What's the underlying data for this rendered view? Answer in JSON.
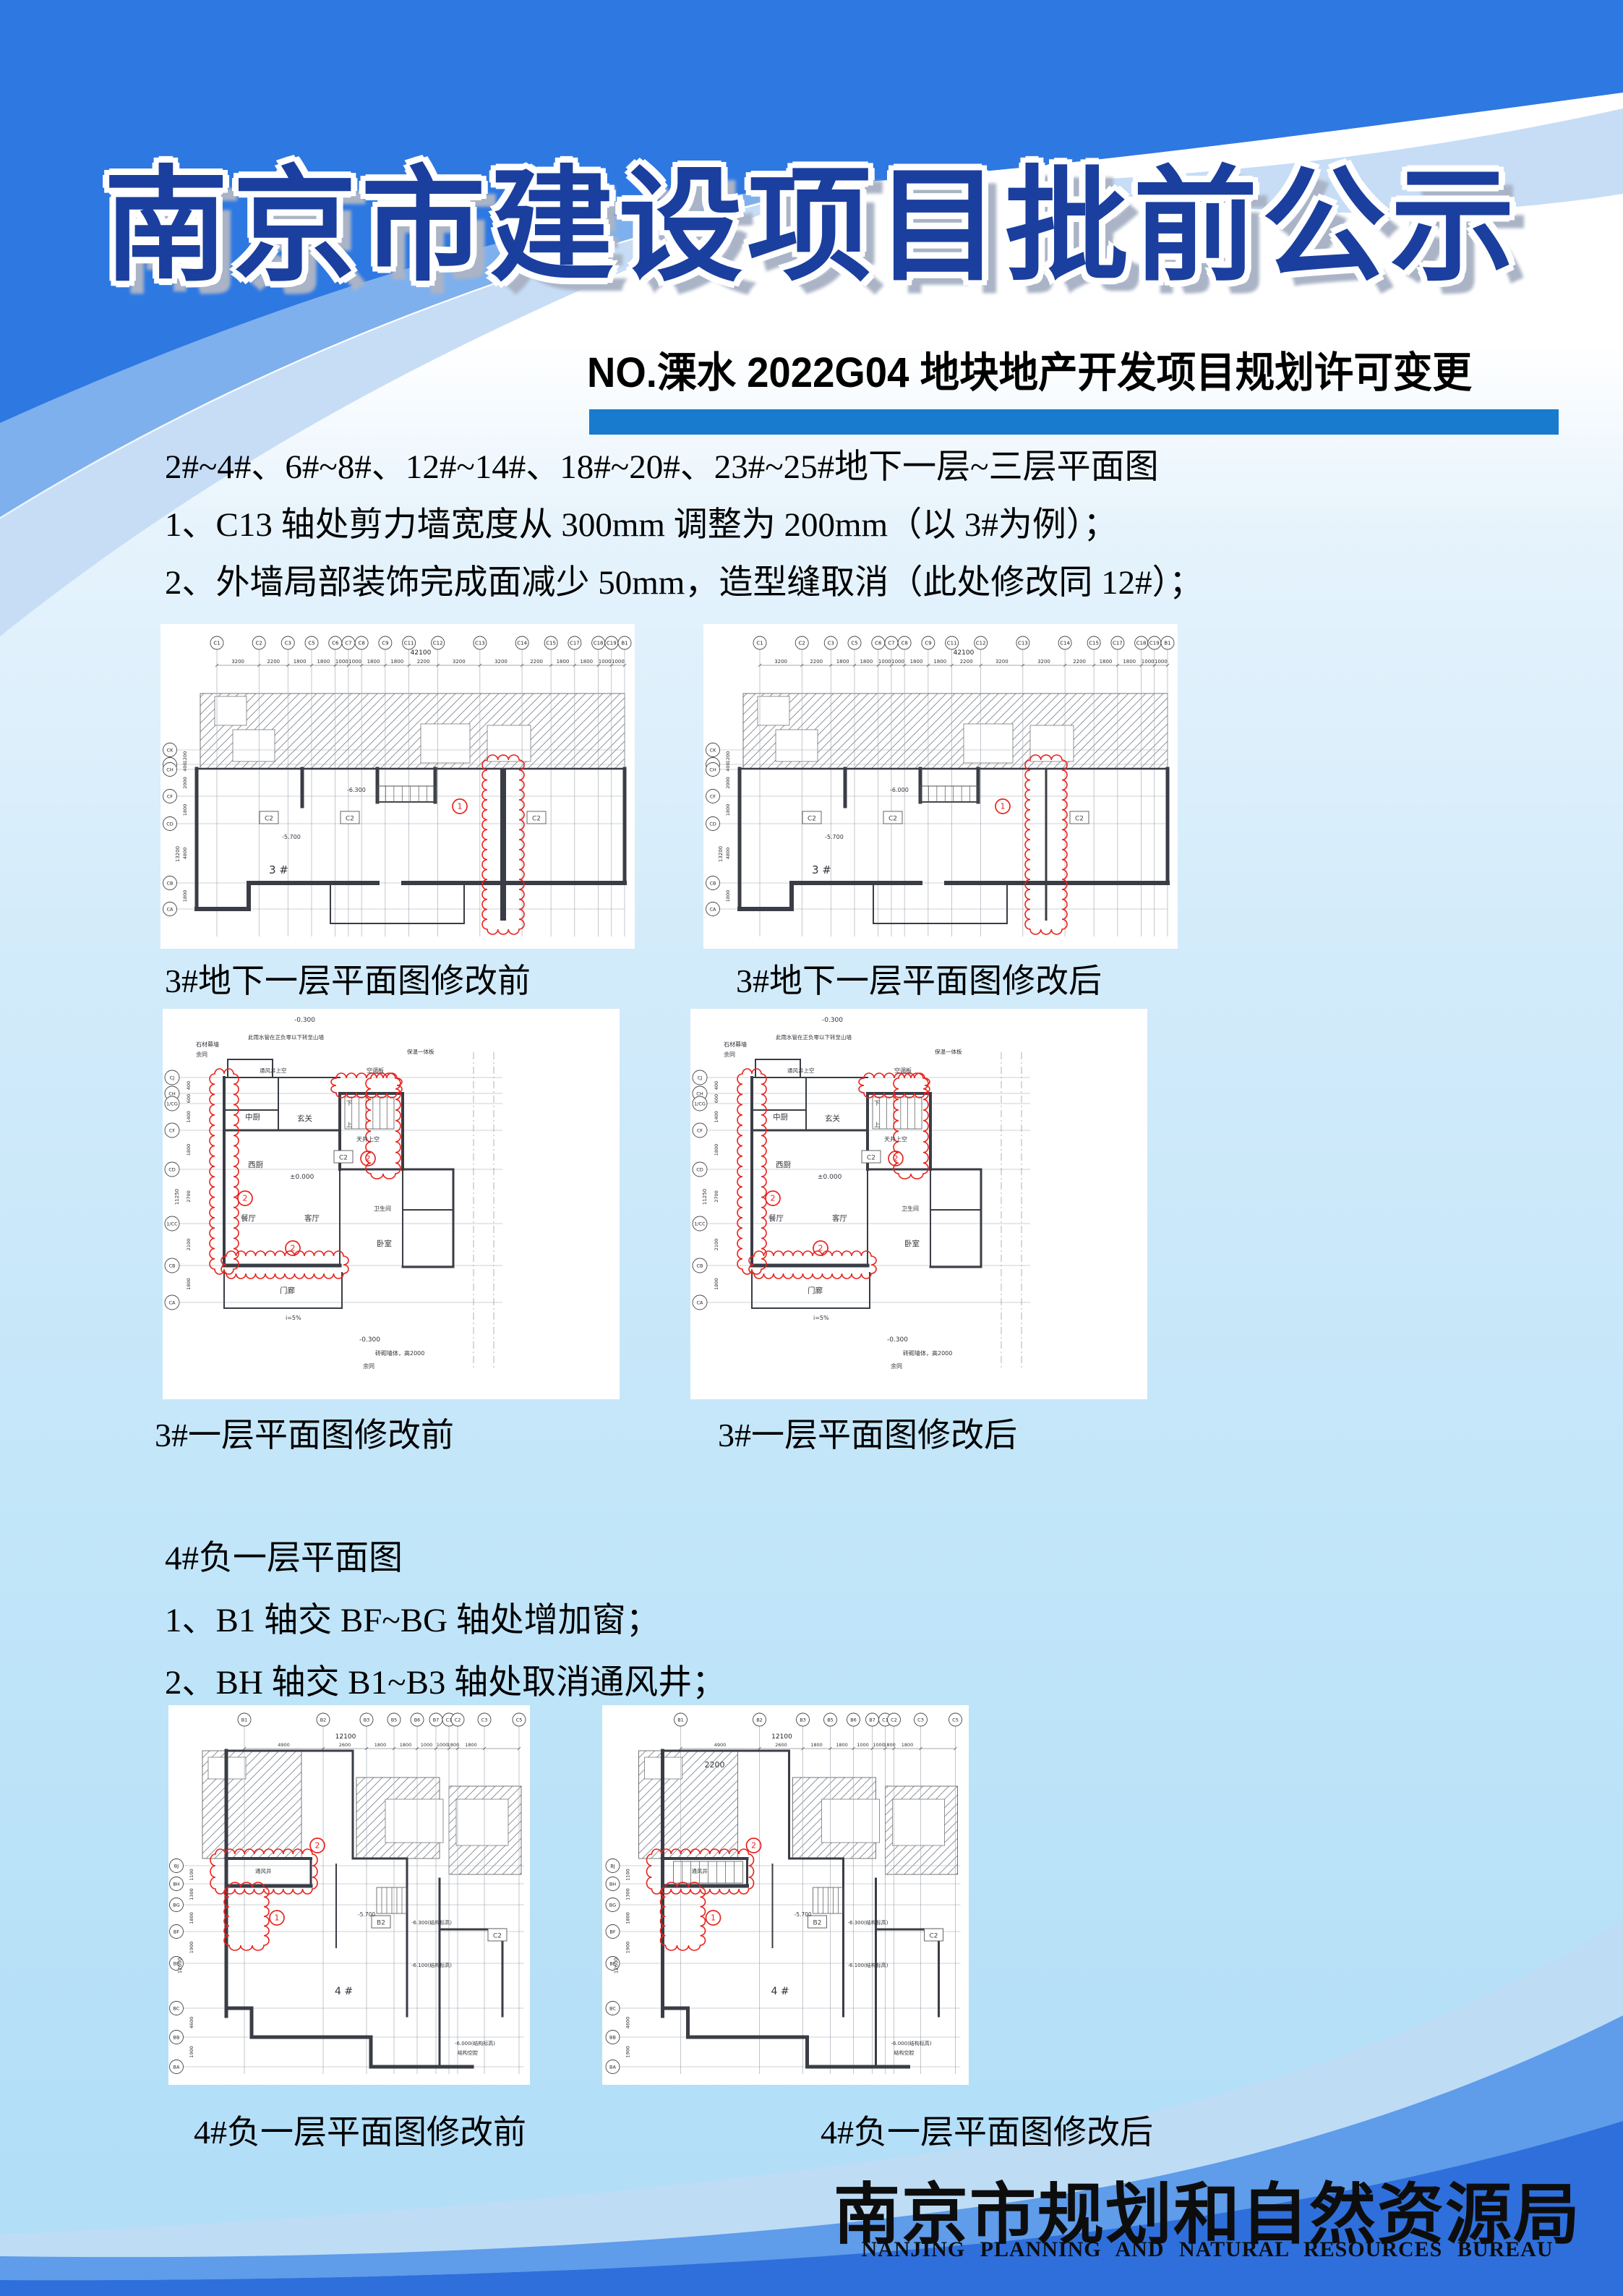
{
  "page": {
    "title": "南京市建设项目批前公示",
    "subtitle": "NO.溧水 2022G04 地块地产开发项目规划许可变更"
  },
  "colors": {
    "accent_bar": "#187bcd",
    "title_navy": "#1b3f9e",
    "swoosh_bright": "#2e78e2",
    "swoosh_medium": "#7fb0ee",
    "swoosh_pale": "#c7ddf6",
    "band_light": "#bfdcf5",
    "band_mid": "#5f9ce9",
    "band_dark": "#2e6fdb",
    "revision_red": "#e8221d"
  },
  "sections": {
    "s1": {
      "line1": "2#~4#、6#~8#、12#~14#、18#~20#、23#~25#地下一层~三层平面图",
      "line2": "1、C13 轴处剪力墙宽度从 300mm 调整为 200mm（以 3#为例）；",
      "line3": "2、外墙局部装饰完成面减少 50mm，造型缝取消（此处修改同 12#）；"
    },
    "s2": {
      "line1": "4#负一层平面图",
      "line2": "1、B1 轴交 BF~BG 轴处增加窗；",
      "line3": "2、BH 轴交 B1~B3 轴处取消通风井；"
    }
  },
  "captions": {
    "c1": "3#地下一层平面图修改前",
    "c2": "3#地下一层平面图修改后",
    "c3": "3#一层平面图修改前",
    "c4": "3#一层平面图修改后",
    "c5": "4#负一层平面图修改前",
    "c6": "4#负一层平面图修改后"
  },
  "footer": {
    "cn": "南京市规划和自然资源局",
    "en": "NANJING PLANNING AND NATURAL RESOURCES BUREAU"
  },
  "plans": [
    {
      "geom": "wide",
      "variant": "before",
      "cols": [
        "C1",
        "C2",
        "C3",
        "C5",
        "C6",
        "C7",
        "C8",
        "C9",
        "C11",
        "C12",
        "C13",
        "C14",
        "C15",
        "C17",
        "C18",
        "C19",
        "B1"
      ],
      "col_dims": [
        "3200",
        "2200",
        "1800",
        "1800",
        "1000",
        "1000",
        "1800",
        "1800",
        "2200",
        "3200",
        "3200",
        "2200",
        "1800",
        "1800",
        "1000",
        "1000"
      ],
      "total_dim": "42100",
      "rows": [
        "CK",
        "CJ",
        "CH",
        "CF",
        "CD",
        "CB",
        "CA"
      ],
      "row_dims": [
        "1200",
        "400",
        "2000",
        "1800",
        "4800",
        "1800"
      ],
      "row_total": "13200",
      "box_labels": [
        "C2",
        "C2",
        "C2"
      ],
      "cloud_numbers": [
        "1"
      ],
      "annotations": [
        "3 #",
        "-5.700",
        "-6.300"
      ]
    },
    {
      "geom": "wide",
      "variant": "after",
      "cols": [
        "C1",
        "C2",
        "C3",
        "C5",
        "C6",
        "C7",
        "C8",
        "C9",
        "C11",
        "C12",
        "C13",
        "C14",
        "C15",
        "C17",
        "C18",
        "C19",
        "B1"
      ],
      "col_dims": [
        "3200",
        "2200",
        "1800",
        "1800",
        "1000",
        "1000",
        "1800",
        "1800",
        "2200",
        "3200",
        "3200",
        "2200",
        "1800",
        "1800",
        "1000",
        "1000"
      ],
      "total_dim": "42100",
      "rows": [
        "CK",
        "CJ",
        "CH",
        "CF",
        "CD",
        "CB",
        "CA"
      ],
      "row_dims": [
        "1200",
        "400",
        "2000",
        "1800",
        "4800",
        "1800"
      ],
      "row_total": "13200",
      "box_labels": [
        "C2",
        "C2",
        "C2"
      ],
      "cloud_numbers": [
        "1"
      ],
      "annotations": [
        "3 #",
        "-5.700",
        "-6.000"
      ]
    },
    {
      "geom": "floor1",
      "variant": "before",
      "cols": [],
      "col_dims": [],
      "total_dim": "",
      "rows": [
        "CJ",
        "CH",
        "1/CG",
        "CF",
        "CD",
        "1/CC",
        "CB",
        "CA"
      ],
      "row_dims": [
        "400",
        "600",
        "1400",
        "1800",
        "2700",
        "2100",
        "1800"
      ],
      "row_total": "11250",
      "box_labels": [
        "C2"
      ],
      "cloud_numbers": [
        "2",
        "2",
        "2"
      ],
      "annotations": [
        "-0.300",
        "石材幕墙",
        "余同",
        "此雨水管在正负零以下转至山墙",
        "通风井上空",
        "空调板",
        "保温一体板",
        "中厨",
        "玄关",
        "西厨",
        "餐厅",
        "客厅",
        "门廊",
        "卧室",
        "卫生间",
        "天井上空",
        "±0.000",
        "下",
        "上",
        "-0.300",
        "砖砌墙体，高2000",
        "余同",
        "i=5%"
      ]
    },
    {
      "geom": "floor1",
      "variant": "after",
      "cols": [],
      "col_dims": [],
      "total_dim": "",
      "rows": [
        "CJ",
        "CH",
        "1/CG",
        "CF",
        "CD",
        "1/CC",
        "CB",
        "CA"
      ],
      "row_dims": [
        "400",
        "600",
        "1400",
        "1800",
        "2700",
        "2100",
        "1800"
      ],
      "row_total": "11250",
      "box_labels": [
        "C2"
      ],
      "cloud_numbers": [
        "2",
        "2",
        "2"
      ],
      "annotations": [
        "-0.300",
        "石材幕墙",
        "余同",
        "此雨水管在正负零以下转至山墙",
        "通风井上空",
        "空调板",
        "保温一体板",
        "中厨",
        "玄关",
        "西厨",
        "餐厅",
        "客厅",
        "门廊",
        "卧室",
        "卫生间",
        "天井上空",
        "±0.000",
        "下",
        "上",
        "-0.300",
        "砖砌墙体，高2000",
        "余同",
        "i=5%"
      ]
    },
    {
      "geom": "b4",
      "variant": "before",
      "cols": [
        "B1",
        "B2",
        "B3",
        "B5",
        "B6",
        "B7",
        "C1",
        "C2",
        "C3",
        "C5"
      ],
      "col_dims": [
        "4900",
        "2600",
        "1800",
        "1800",
        "1000",
        "1000",
        "1800",
        "1800",
        ""
      ],
      "total_dim": "12100",
      "rows": [
        "BJ",
        "BH",
        "BG",
        "BF",
        "BE",
        "BC",
        "BB",
        "BA"
      ],
      "row_dims": [
        "1100",
        "1300",
        "1800",
        "1900",
        "",
        "4600",
        "1900"
      ],
      "row_total": "12600",
      "box_labels": [
        "B2",
        "C2"
      ],
      "cloud_numbers": [
        "2",
        "1"
      ],
      "annotations": [
        "4 #",
        "通风井",
        "-5.700",
        "-6.300(结构标高)",
        "-6.100(结构标高)",
        "-6.000(结构标高)",
        "结构空腔"
      ]
    },
    {
      "geom": "b4",
      "variant": "after",
      "cols": [
        "B1",
        "B2",
        "B3",
        "B5",
        "B6",
        "B7",
        "C1",
        "C2",
        "C3",
        "C5"
      ],
      "col_dims": [
        "4900",
        "2600",
        "1800",
        "1800",
        "1000",
        "1000",
        "1800",
        "1800",
        ""
      ],
      "total_dim": "12100",
      "rows": [
        "BJ",
        "BH",
        "BG",
        "BF",
        "BE",
        "BC",
        "BB",
        "BA"
      ],
      "row_dims": [
        "1100",
        "1300",
        "1800",
        "1900",
        "",
        "4600",
        "1900"
      ],
      "row_total": "12600",
      "box_labels": [
        "B2",
        "C2"
      ],
      "cloud_numbers": [
        "2",
        "1"
      ],
      "annotations": [
        "4 #",
        "通风井",
        "-5.700",
        "-6.300(结构标高)",
        "-6.100(结构标高)",
        "-6.000(结构标高)",
        "结构空腔",
        "2200"
      ]
    }
  ]
}
